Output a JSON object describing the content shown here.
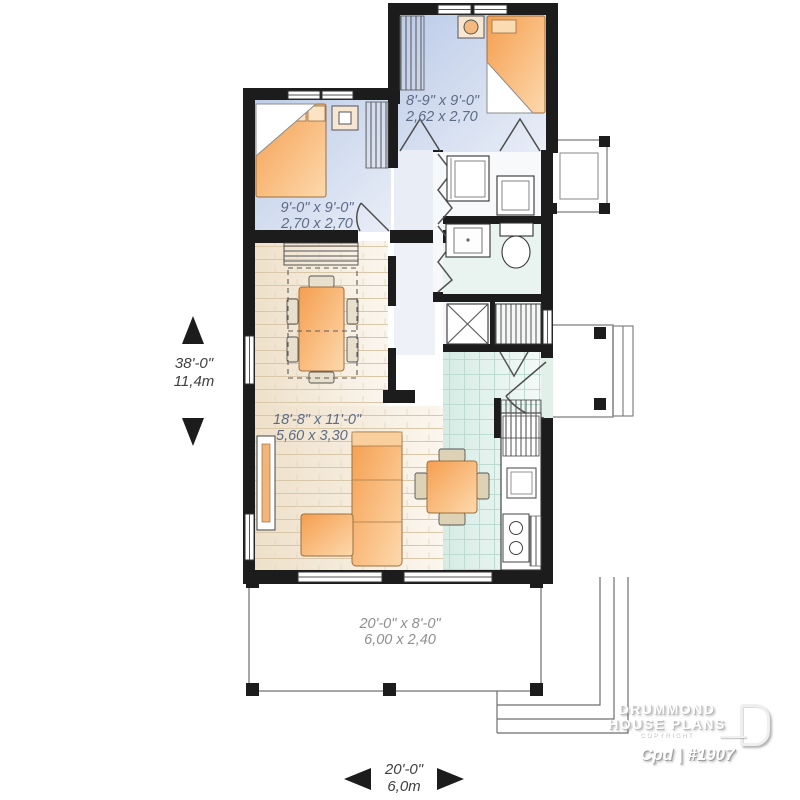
{
  "rooms": {
    "bedroom1": {
      "imperial": "8'-9\" x 9'-0\"",
      "metric": "2,62 x 2,70"
    },
    "bedroom2": {
      "imperial": "9'-0\" x 9'-0\"",
      "metric": "2,70 x 2,70"
    },
    "living": {
      "imperial": "18'-8\" x 11'-0\"",
      "metric": "5,60 x 3,30"
    },
    "porch": {
      "imperial": "20'-0\" x 8'-0\"",
      "metric": "6,00 x 2,40"
    }
  },
  "dimensions": {
    "depth": {
      "imperial": "38'-0\"",
      "metric": "11,4m"
    },
    "width": {
      "imperial": "20'-0\"",
      "metric": "6,0m"
    }
  },
  "branding": {
    "name_line1": "DRUMMOND",
    "name_line2": "HOUSE PLANS",
    "copyright": "COPYRIGHT",
    "plan_ref": "Cpd | #1907"
  },
  "colors": {
    "wall": "#1c1c1c",
    "bedroom_floor": "#c9d4ea",
    "wood_floor": "#f2e7d4",
    "tile_floor": "#dcefe9",
    "furniture_orange": "#f6a95c",
    "label_blue": "#5d6b85",
    "label_gray": "#8f8f8f",
    "dim_dark": "#404040"
  }
}
